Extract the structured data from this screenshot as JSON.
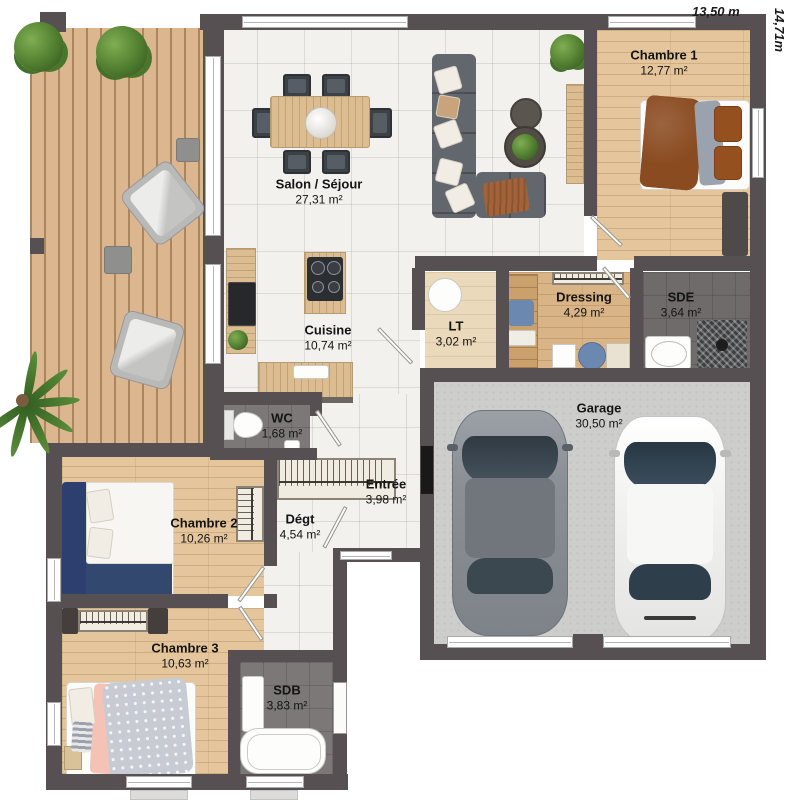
{
  "dimensions": {
    "width_label": "13,50 m",
    "height_label": "14,71m"
  },
  "rooms": {
    "chambre1": {
      "name": "Chambre 1",
      "area": "12,77 m²"
    },
    "salon": {
      "name": "Salon / Séjour",
      "area": "27,31 m²"
    },
    "cuisine": {
      "name": "Cuisine",
      "area": "10,74 m²"
    },
    "lt": {
      "name": "LT",
      "area": "3,02 m²"
    },
    "dressing": {
      "name": "Dressing",
      "area": "4,29 m²"
    },
    "sde": {
      "name": "SDE",
      "area": "3,64 m²"
    },
    "garage": {
      "name": "Garage",
      "area": "30,50 m²"
    },
    "wc": {
      "name": "WC",
      "area": "1,68 m²"
    },
    "entree": {
      "name": "Entrée",
      "area": "3,98 m²"
    },
    "degt": {
      "name": "Dégt",
      "area": "4,54 m²"
    },
    "chambre2": {
      "name": "Chambre 2",
      "area": "10,26 m²"
    },
    "chambre3": {
      "name": "Chambre 3",
      "area": "10,63 m²"
    },
    "sdb": {
      "name": "SDB",
      "area": "3,83 m²"
    }
  },
  "colors": {
    "wall": "#575052",
    "tile_floor": "#f2f1ee",
    "wood_floor": "#e5c69c",
    "terrace_wood": "#dcb68e",
    "wet_room_floor": "#7b7877",
    "garage_floor": "#cdcecc",
    "bed_blue": "#2c3f6e",
    "duvet_brown": "#8a4b20",
    "greenery": "#4f7d2f"
  }
}
